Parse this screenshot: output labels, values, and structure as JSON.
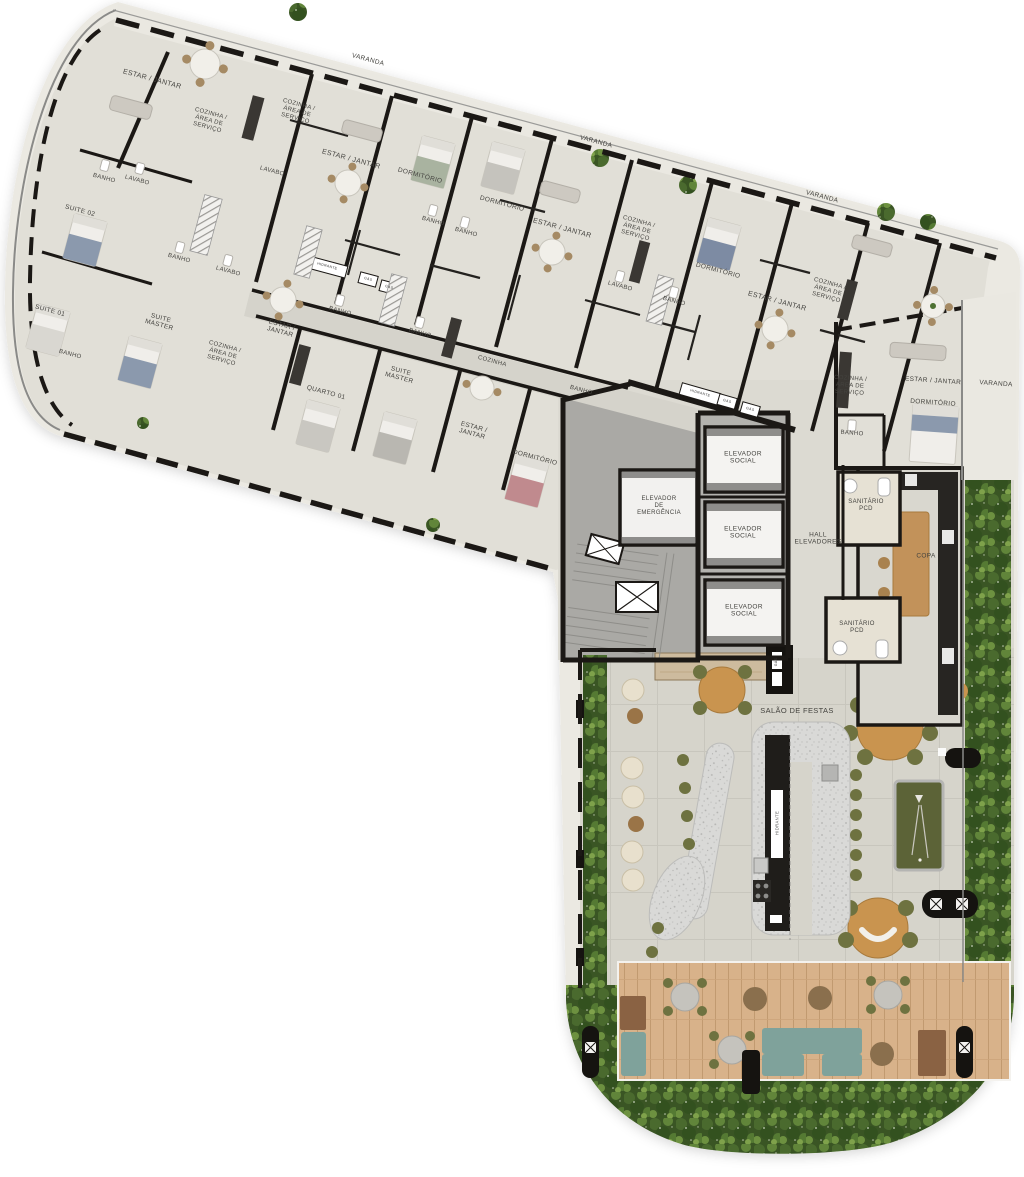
{
  "plan": {
    "kind": "residential floor plan",
    "amenity": "SALÃO DE FESTAS"
  },
  "colors": {
    "background": "#ffffff",
    "walls": "#1b1815",
    "floor_band": "#e1dfd7",
    "floor_balcony": "#eae8e1",
    "floor_corridor": "#d5d3cb",
    "floor_salao": "#d6d4cb",
    "core_gray": "#aaa9a5",
    "deck_wood": "#d8b28a",
    "foliage_green": "#3f5e28",
    "terrazzo": "#d9d9d7",
    "pool_felt": "#5c6337",
    "wood_furniture": "#bc8c52",
    "olive_chair": "#6e7240",
    "teal_sofa": "#7fa29b",
    "bed_blue": "#8b99ad",
    "bed_pink": "#c08a8e",
    "bed_sage": "#a9b3a0",
    "cream_pouf": "#e8e0cd"
  },
  "labels": [
    {
      "n": "room-label-estar-jantar-1",
      "t": "ESTAR / JANTAR",
      "x": 152,
      "y": 80,
      "r": 15,
      "s": 7
    },
    {
      "n": "room-label-cozinha-1",
      "t": "COZINHA /\nÁREA DE\nSERVIÇO",
      "x": 209,
      "y": 121,
      "r": 15,
      "s": 6
    },
    {
      "n": "room-label-cozinha-2",
      "t": "COZINHA /\nÁREA DE\nSERVIÇO",
      "x": 297,
      "y": 112,
      "r": 15,
      "s": 6
    },
    {
      "n": "room-label-lavabo-1",
      "t": "LAVABO",
      "x": 272,
      "y": 172,
      "r": 15,
      "s": 6
    },
    {
      "n": "room-label-banho-1",
      "t": "BANHO",
      "x": 104,
      "y": 179,
      "r": 15,
      "s": 6
    },
    {
      "n": "room-label-lavabo-2",
      "t": "LAVABO",
      "x": 137,
      "y": 181,
      "r": 15,
      "s": 6
    },
    {
      "n": "room-label-suite-02",
      "t": "SUITE 02",
      "x": 80,
      "y": 211,
      "r": 15,
      "s": 6.5
    },
    {
      "n": "room-label-suite-01",
      "t": "SUITE 01",
      "x": 50,
      "y": 311,
      "r": 15,
      "s": 6.5
    },
    {
      "n": "room-label-banho-2",
      "t": "BANHO",
      "x": 70,
      "y": 355,
      "r": 15,
      "s": 6
    },
    {
      "n": "room-label-suite-master-1",
      "t": "SUITE\nMASTER",
      "x": 160,
      "y": 322,
      "r": 15,
      "s": 6.5
    },
    {
      "n": "room-label-banho-3",
      "t": "BANHO",
      "x": 179,
      "y": 259,
      "r": 15,
      "s": 6
    },
    {
      "n": "room-label-lavabo-3",
      "t": "LAVABO",
      "x": 228,
      "y": 272,
      "r": 15,
      "s": 6
    },
    {
      "n": "room-label-estar-jantar-2",
      "t": "ESTAR /\nJANTAR",
      "x": 281,
      "y": 329,
      "r": 15,
      "s": 6.5
    },
    {
      "n": "room-label-cozinha-3",
      "t": "COZINHA /\nÁREA DE\nSERVIÇO",
      "x": 223,
      "y": 354,
      "r": 15,
      "s": 6
    },
    {
      "n": "room-label-quarto-01",
      "t": "QUARTO 01",
      "x": 326,
      "y": 393,
      "r": 15,
      "s": 6.5
    },
    {
      "n": "room-label-suite-master-2",
      "t": "SUITE\nMASTER",
      "x": 400,
      "y": 375,
      "r": 15,
      "s": 6.5
    },
    {
      "n": "room-label-banho-4",
      "t": "BANHO",
      "x": 340,
      "y": 312,
      "r": 15,
      "s": 6
    },
    {
      "n": "room-label-banho-5",
      "t": "BANHO",
      "x": 420,
      "y": 334,
      "r": 15,
      "s": 6
    },
    {
      "n": "room-label-cozinha-4",
      "t": "COZINHA",
      "x": 492,
      "y": 362,
      "r": 15,
      "s": 6
    },
    {
      "n": "room-label-estar-jantar-3",
      "t": "ESTAR /\nJANTAR",
      "x": 473,
      "y": 431,
      "r": 15,
      "s": 6.5
    },
    {
      "n": "room-label-dormitorio-1",
      "t": "DORMITÓRIO",
      "x": 535,
      "y": 458,
      "r": 15,
      "s": 6.5
    },
    {
      "n": "room-label-banho-6",
      "t": "BANHO",
      "x": 581,
      "y": 391,
      "r": 15,
      "s": 6
    },
    {
      "n": "room-label-varanda-1",
      "t": "VARANDA",
      "x": 368,
      "y": 60,
      "r": 15,
      "s": 6.5
    },
    {
      "n": "room-label-estar-jantar-4",
      "t": "ESTAR / JANTAR",
      "x": 351,
      "y": 160,
      "r": 15,
      "s": 7
    },
    {
      "n": "room-label-dormitorio-2",
      "t": "DORMITÓRIO",
      "x": 420,
      "y": 176,
      "r": 15,
      "s": 6.5
    },
    {
      "n": "room-label-banho-7",
      "t": "BANHO",
      "x": 433,
      "y": 222,
      "r": 15,
      "s": 6
    },
    {
      "n": "room-label-dormitorio-3",
      "t": "DORMITÓRIO",
      "x": 502,
      "y": 204,
      "r": 15,
      "s": 6.5
    },
    {
      "n": "room-label-banho-8",
      "t": "BANHO",
      "x": 466,
      "y": 233,
      "r": 15,
      "s": 6
    },
    {
      "n": "room-label-varanda-2",
      "t": "VARANDA",
      "x": 596,
      "y": 142,
      "r": 15,
      "s": 6.5
    },
    {
      "n": "room-label-estar-jantar-5",
      "t": "ESTAR / JANTAR",
      "x": 562,
      "y": 229,
      "r": 15,
      "s": 7
    },
    {
      "n": "room-label-cozinha-5",
      "t": "COZINHA /\nÁREA DE\nSERVIÇO",
      "x": 637,
      "y": 229,
      "r": 15,
      "s": 6
    },
    {
      "n": "room-label-lavabo-4",
      "t": "LAVABO",
      "x": 620,
      "y": 287,
      "r": 15,
      "s": 6
    },
    {
      "n": "room-label-banho-9",
      "t": "BANHO",
      "x": 674,
      "y": 302,
      "r": 15,
      "s": 6
    },
    {
      "n": "room-label-dormitorio-4",
      "t": "DORMITÓRIO",
      "x": 718,
      "y": 271,
      "r": 15,
      "s": 6.5
    },
    {
      "n": "room-label-estar-jantar-6",
      "t": "ESTAR / JANTAR",
      "x": 777,
      "y": 302,
      "r": 15,
      "s": 7
    },
    {
      "n": "room-label-varanda-3",
      "t": "VARANDA",
      "x": 822,
      "y": 197,
      "r": 15,
      "s": 6.5
    },
    {
      "n": "room-label-cozinha-6",
      "t": "COZINHA /\nÁREA DE\nSERVIÇO",
      "x": 828,
      "y": 291,
      "r": 15,
      "s": 6
    },
    {
      "n": "room-label-cozinha-7",
      "t": "COZINHA /\nÁREA DE\nSERVIÇO",
      "x": 850,
      "y": 386,
      "r": 4,
      "s": 6
    },
    {
      "n": "room-label-estar-jantar-7",
      "t": "ESTAR / JANTAR",
      "x": 933,
      "y": 381,
      "r": 4,
      "s": 6.5
    },
    {
      "n": "room-label-dormitorio-5",
      "t": "DORMITÓRIO",
      "x": 933,
      "y": 403,
      "r": 4,
      "s": 6.5
    },
    {
      "n": "room-label-varanda-4",
      "t": "VARANDA",
      "x": 996,
      "y": 384,
      "r": 4,
      "s": 6.5
    },
    {
      "n": "room-label-banho-10",
      "t": "BANHO",
      "x": 852,
      "y": 434,
      "r": 4,
      "s": 6
    },
    {
      "n": "room-label-elevador-social-1",
      "t": "ELEVADOR\nSOCIAL",
      "x": 743,
      "y": 458,
      "r": 0,
      "s": 6.5
    },
    {
      "n": "room-label-elevador-social-2",
      "t": "ELEVADOR\nSOCIAL",
      "x": 743,
      "y": 533,
      "r": 0,
      "s": 6.5
    },
    {
      "n": "room-label-elevador-social-3",
      "t": "ELEVADOR\nSOCIAL",
      "x": 744,
      "y": 611,
      "r": 0,
      "s": 6.5
    },
    {
      "n": "room-label-elevador-emergencia",
      "t": "ELEVADOR\nDE\nEMERGÊNCIA",
      "x": 659,
      "y": 506,
      "r": 0,
      "s": 6
    },
    {
      "n": "room-label-hall-elevadores",
      "t": "HALL\nELEVADORES",
      "x": 818,
      "y": 539,
      "r": 0,
      "s": 6.5
    },
    {
      "n": "room-label-sanitario-pcd-1",
      "t": "SANITÁRIO\nPCD",
      "x": 866,
      "y": 506,
      "r": 0,
      "s": 6
    },
    {
      "n": "room-label-sanitario-pcd-2",
      "t": "SANITÁRIO\nPCD",
      "x": 857,
      "y": 628,
      "r": 0,
      "s": 6
    },
    {
      "n": "room-label-copa",
      "t": "COPA",
      "x": 926,
      "y": 556,
      "r": 0,
      "s": 6.5
    },
    {
      "n": "room-label-salao-de-festas",
      "t": "SALÃO DE FESTAS",
      "x": 797,
      "y": 711,
      "r": 0,
      "s": 7.5
    },
    {
      "n": "shaft-label-hidrante-1",
      "t": "HIDRANTE",
      "x": 327,
      "y": 267,
      "r": 15,
      "s": 3.5,
      "c": "#333"
    },
    {
      "n": "shaft-label-gas-1",
      "t": "GÁS",
      "x": 368,
      "y": 280,
      "r": 15,
      "s": 3.5,
      "c": "#333"
    },
    {
      "n": "shaft-label-gas-2",
      "t": "GÁS",
      "x": 389,
      "y": 288,
      "r": 15,
      "s": 3.5,
      "c": "#333"
    },
    {
      "n": "shaft-label-hidrante-2",
      "t": "HIDRANTE",
      "x": 700,
      "y": 394,
      "r": 16,
      "s": 3.5,
      "c": "#333"
    },
    {
      "n": "shaft-label-gas-3",
      "t": "GÁS",
      "x": 727,
      "y": 402,
      "r": 16,
      "s": 3.5,
      "c": "#333"
    },
    {
      "n": "shaft-label-gas-4",
      "t": "GÁS",
      "x": 750,
      "y": 410,
      "r": 16,
      "s": 3.5,
      "c": "#333"
    },
    {
      "n": "shaft-label-gas-5",
      "t": "GÁS",
      "x": 777,
      "y": 662,
      "r": -90,
      "s": 3.5,
      "c": "#3a3a3a"
    },
    {
      "n": "shaft-label-hidrante-3",
      "t": "HIDRANTE",
      "x": 778,
      "y": 823,
      "r": -90,
      "s": 4.2,
      "c": "#555"
    }
  ]
}
